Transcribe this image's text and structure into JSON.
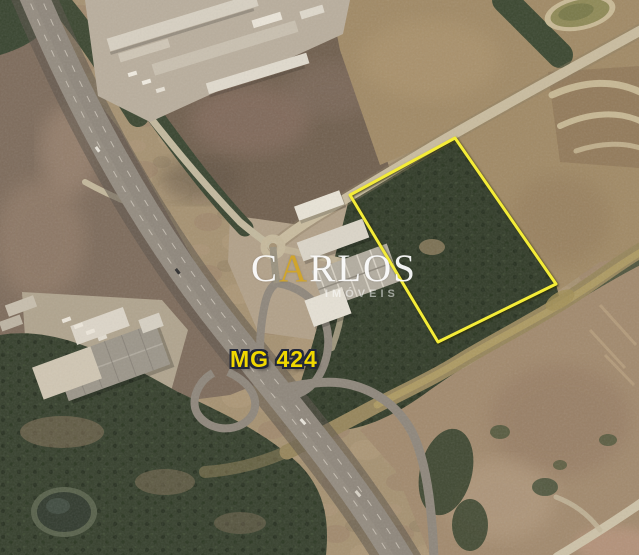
{
  "map": {
    "road_label": "MG 424",
    "parcel": {
      "points": "455,138 556,284 438,342 350,195",
      "outline_color": "#f4ec38"
    },
    "colors": {
      "road_label_text": "#f0d800",
      "road_label_outline": "#23283a"
    }
  },
  "watermark": {
    "name": "CARLOS",
    "name_parts": {
      "first": "C",
      "accent": "A",
      "rest": "RLOS"
    },
    "subtitle": "IMÓVEIS",
    "colors": {
      "text": "#ffffff",
      "accent": "#d0a52d"
    }
  }
}
